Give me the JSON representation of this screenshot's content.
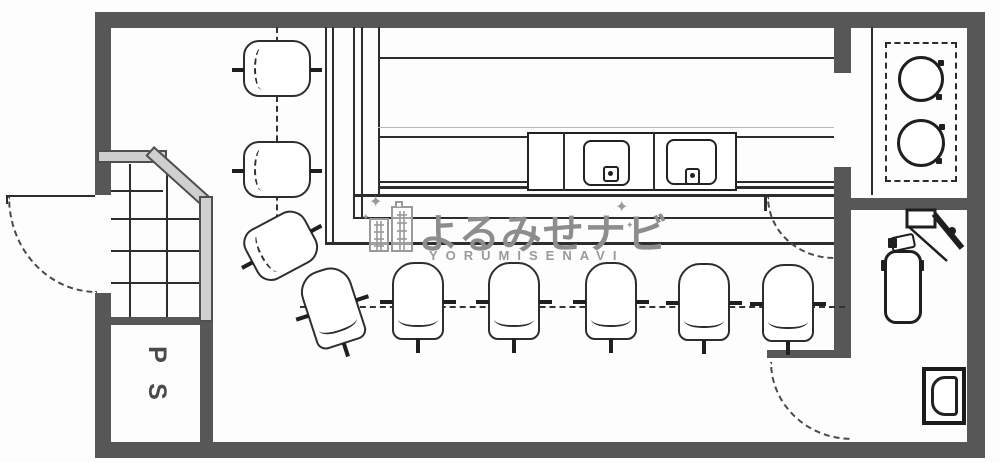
{
  "pipe_shaft": {
    "letter_top": "P",
    "letter_bottom": "S"
  },
  "watermark": {
    "title_jp": "よるみせナビ",
    "title_en": "YORUMISENAVI",
    "sparkle": "✦",
    "icon": "city-buildings-icon",
    "color": "#8d8d8d"
  },
  "colors": {
    "wall": "#575757",
    "line": "#2d2d2d",
    "handrail_fill": "#cfcfcf",
    "light_line": "#b9b9b9",
    "background": "#ffffff"
  },
  "fixtures": {
    "entrance_door": "swing-door-arc",
    "staircase": "stairs-with-handrail",
    "pipe_shaft_room": "PS",
    "bar_counter": "L-shaped-counter",
    "kitchen_sink_unit": "double-sink",
    "stove": "two-burner-stove",
    "restroom": [
      "corner-sink",
      "water-heater-cylinder",
      "toilet"
    ],
    "kitchen_pass_door": "swing-door-arc",
    "restroom_door": "swing-door-arc"
  },
  "seats": {
    "left_counter_chairs": 3,
    "front_counter_chairs": 6,
    "total": 9
  }
}
